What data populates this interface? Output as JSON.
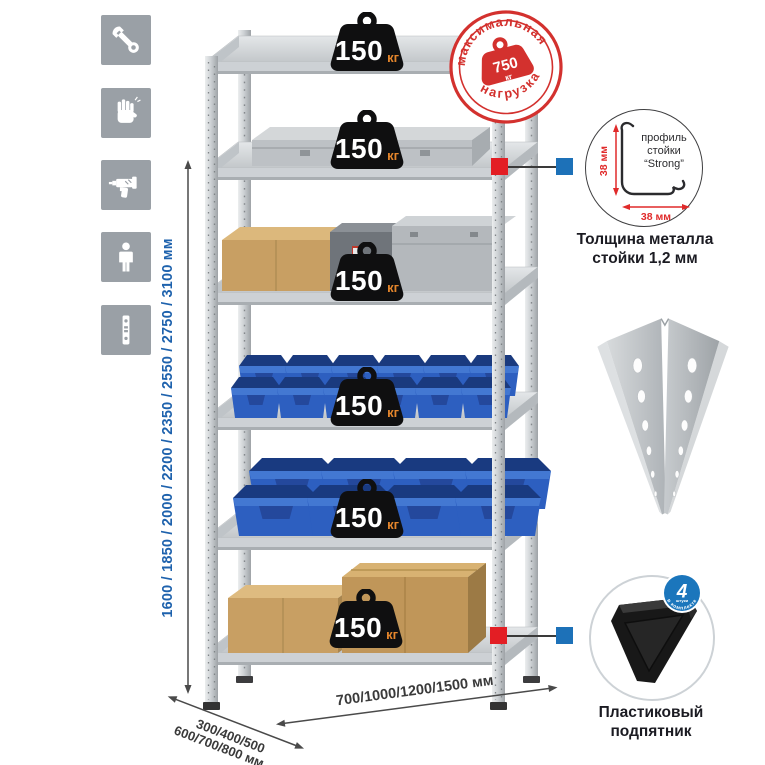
{
  "assembly_icons": {
    "items": [
      {
        "name": "wrench-icon"
      },
      {
        "name": "gloves-icon"
      },
      {
        "name": "drill-icon"
      },
      {
        "name": "person-icon"
      },
      {
        "name": "post-strip-icon"
      }
    ]
  },
  "dimensions": {
    "height_options": "1600 / 1850 / 2000 / 2200 / 2350 / 2550 / 2750 / 3100 мм",
    "depth_options_line1": "300/400/500",
    "depth_options_line2": "600/700/800 мм",
    "width_options": "700/1000/1200/1500 мм"
  },
  "rack": {
    "shelf_count": 6,
    "shelf_loads": [
      {
        "value": "150",
        "unit": "кг"
      },
      {
        "value": "150",
        "unit": "кг"
      },
      {
        "value": "150",
        "unit": "кг"
      },
      {
        "value": "150",
        "unit": "кг"
      },
      {
        "value": "150",
        "unit": "кг"
      },
      {
        "value": "150",
        "unit": "кг"
      }
    ]
  },
  "max_load_stamp": {
    "arc_top": "максимальная",
    "arc_bottom": "нагрузка",
    "weight_value": "750",
    "weight_unit": "кг"
  },
  "post_profile_detail": {
    "label_line1": "профиль",
    "label_line2": "стойки",
    "label_line3": "“Strong”",
    "height_dim": "38 мм",
    "width_dim": "38 мм",
    "caption_line1": "Толщина металла",
    "caption_line2": "стойки 1,2 мм"
  },
  "foot_detail": {
    "badge_value": "4",
    "badge_sub": "штуки",
    "badge_arc": "в комплекте",
    "caption_line1": "Пластиковый",
    "caption_line2": "подпятник"
  },
  "colors": {
    "stamp_red": "#d3312e",
    "connector_red": "#e31e24",
    "connector_blue": "#1d71b8",
    "dimension_blue": "#1e62ad",
    "badge_unit_orange": "#e5862c",
    "bin_blue": "#2d5fc0"
  }
}
